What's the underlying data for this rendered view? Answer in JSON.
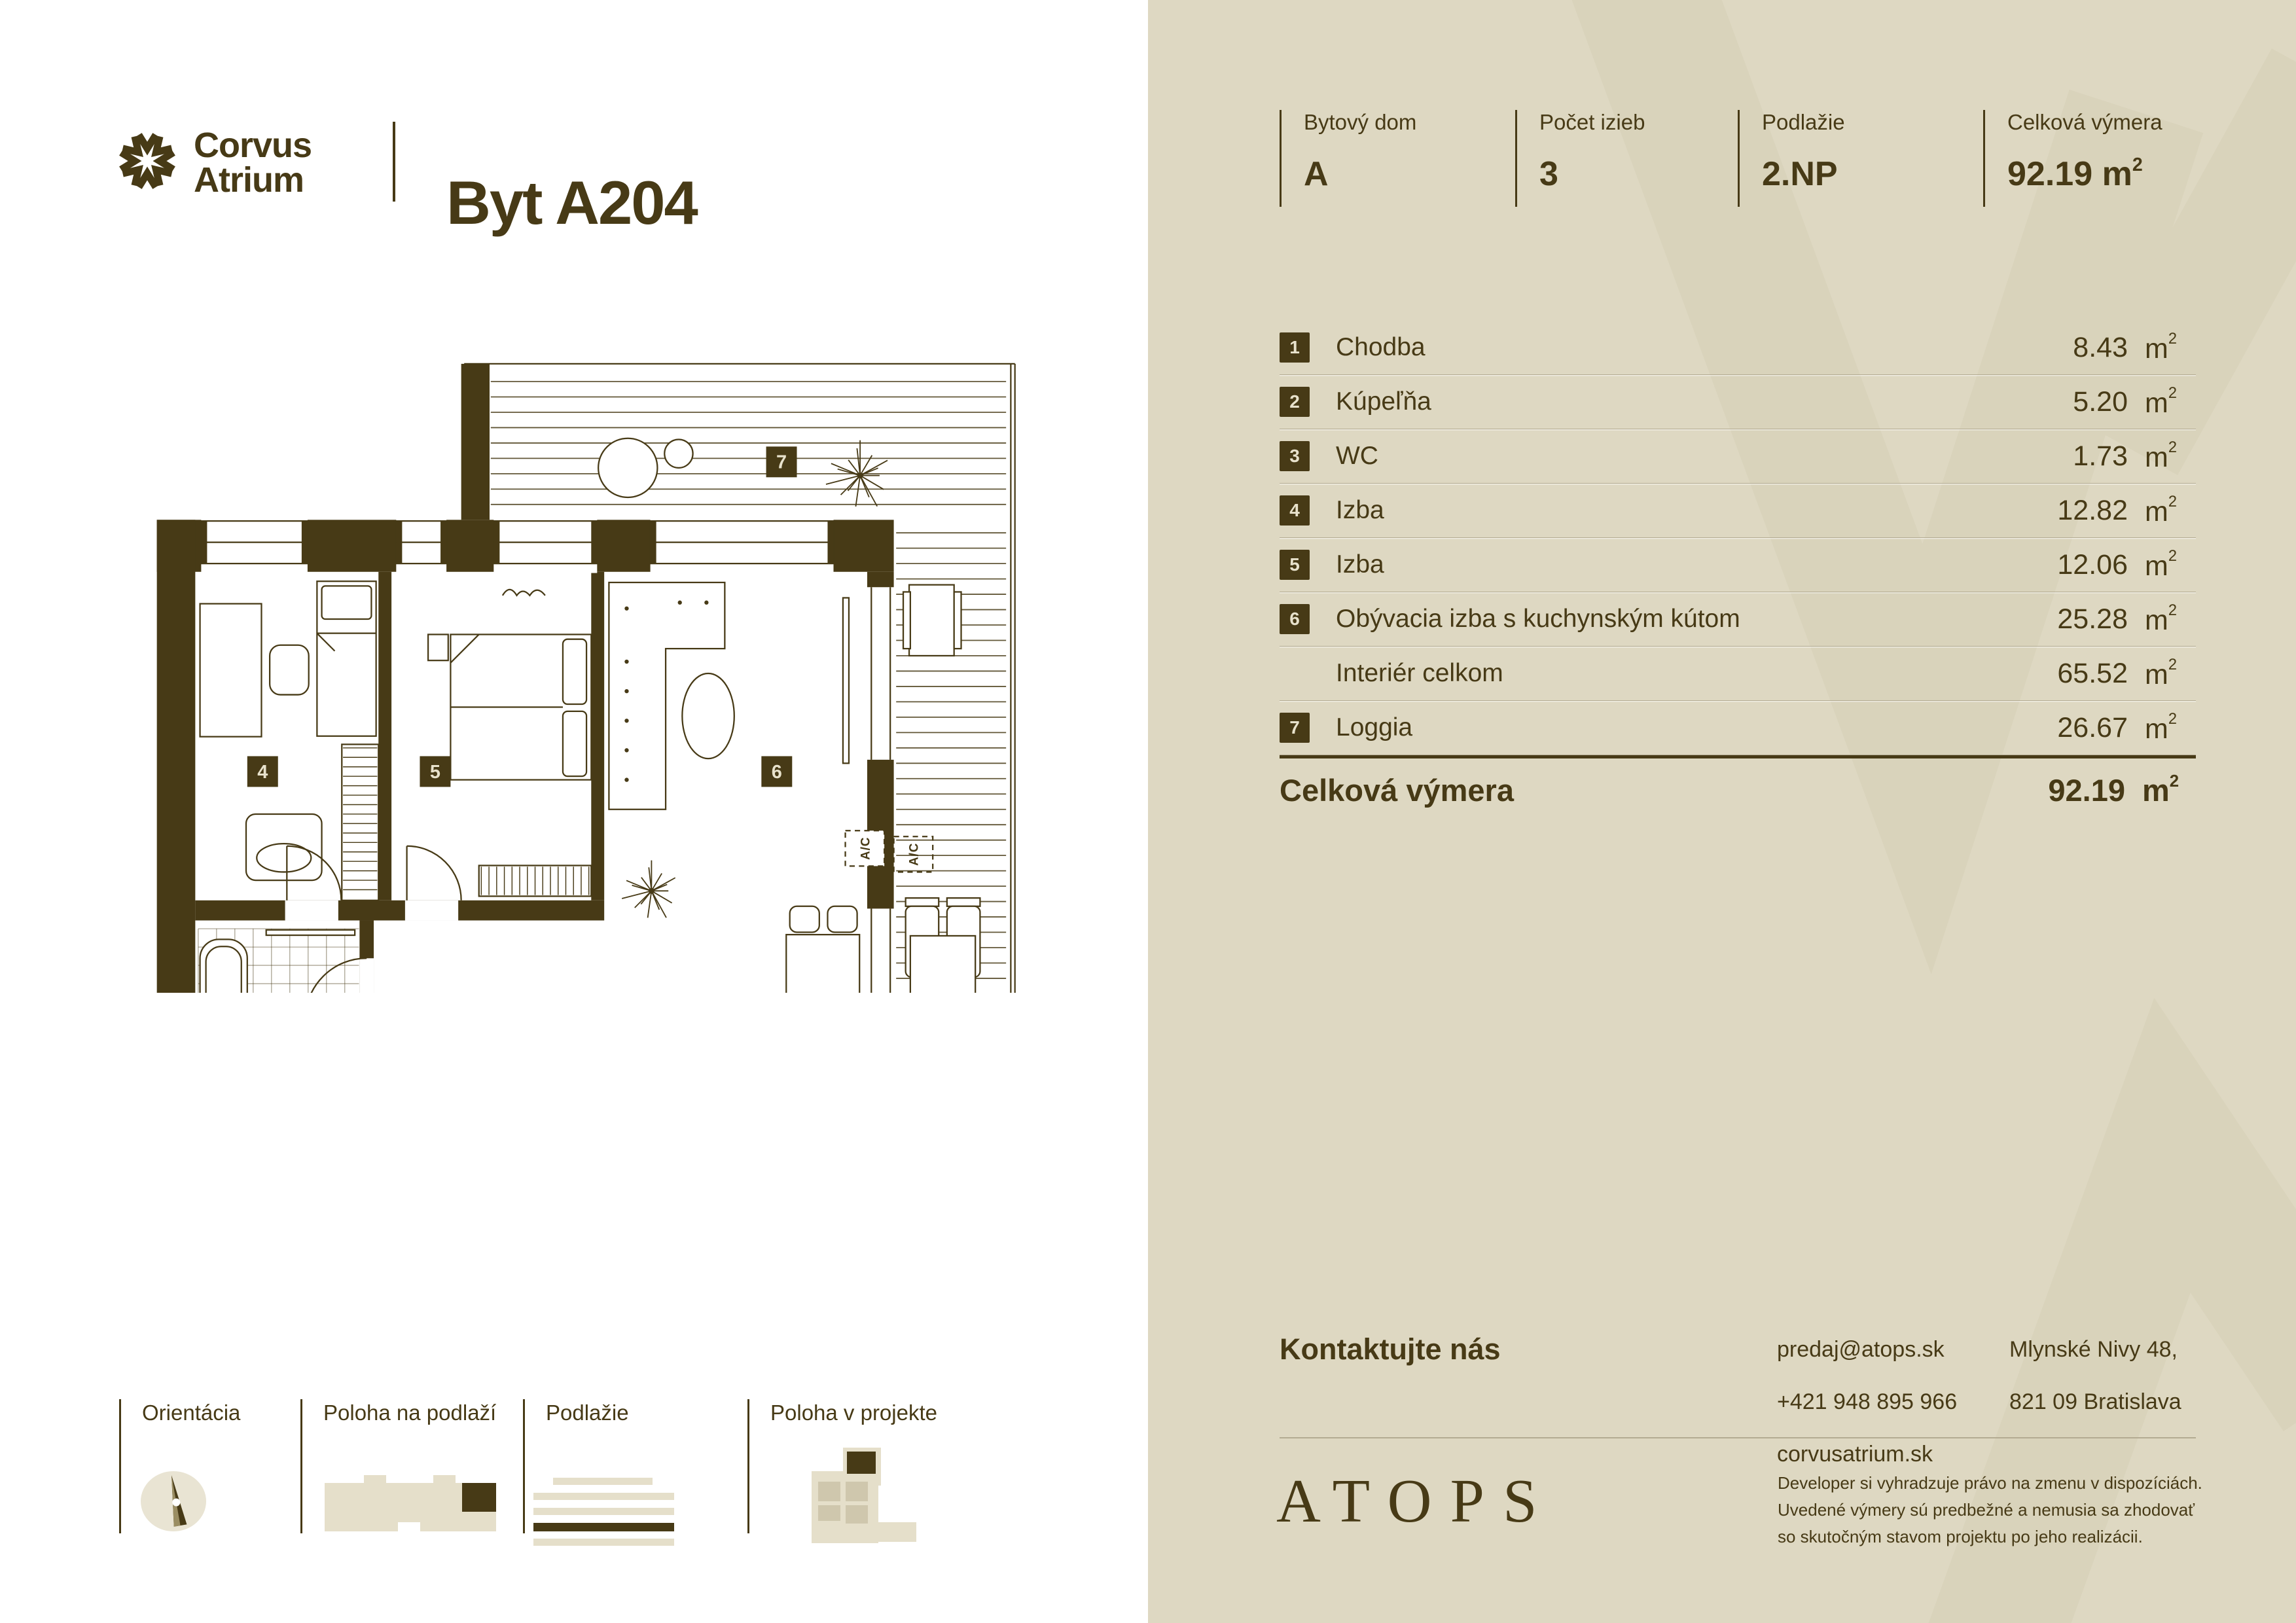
{
  "colors": {
    "accent_dark_brown": "#473a16",
    "panel_beige": "#ded8c2",
    "watermark_beige": "#d6cfb6",
    "badge_number": "#e8e2cc",
    "rule": "#b3ab92"
  },
  "brand": {
    "logo_line1": "Corvus",
    "logo_line2": "Atrium",
    "apartment": "Byt A204",
    "developer": "ATOPS"
  },
  "specs": {
    "cols": [
      {
        "label": "Bytový dom",
        "value": "A"
      },
      {
        "label": "Počet izieb",
        "value": "3"
      },
      {
        "label": "Podlažie",
        "value": "2.NP"
      },
      {
        "label": "Celková výmera",
        "value": "92.19",
        "unit_base": "m",
        "unit_sup": "2"
      }
    ]
  },
  "table": {
    "unit_base": "m",
    "unit_sup": "2",
    "rows": [
      {
        "num": "1",
        "name": "Chodba",
        "area": "8.43"
      },
      {
        "num": "2",
        "name": "Kúpeľňa",
        "area": "5.20"
      },
      {
        "num": "3",
        "name": "WC",
        "area": "1.73"
      },
      {
        "num": "4",
        "name": "Izba",
        "area": "12.82"
      },
      {
        "num": "5",
        "name": "Izba",
        "area": "12.06"
      },
      {
        "num": "6",
        "name": "Obývacia izba s kuchynským kútom",
        "area": "25.28"
      },
      {
        "num": "",
        "name": "Interiér celkom",
        "area": "65.52"
      },
      {
        "num": "7",
        "name": "Loggia",
        "area": "26.67"
      }
    ],
    "total_label": "Celková výmera",
    "total_area": "92.19"
  },
  "contact": {
    "title": "Kontaktujte nás",
    "lines": [
      "predaj@atops.sk",
      "+421 948 895 966",
      "corvusatrium.sk"
    ],
    "address": [
      "Mlynské Nivy 48,",
      "821 09 Bratislava"
    ]
  },
  "disclaimer": [
    "Developer si vyhradzuje právo na zmenu v dispozíciách.",
    "Uvedené výmery sú predbežné a nemusia sa zhodovať",
    "so skutočným stavom projektu po jeho realizácii."
  ],
  "legend": {
    "items": [
      {
        "label": "Orientácia"
      },
      {
        "label": "Poloha na podlaží"
      },
      {
        "label": "Podlažie"
      },
      {
        "label": "Poloha v projekte"
      }
    ]
  },
  "plan": {
    "ac": "A/C",
    "badges": [
      {
        "n": "1"
      },
      {
        "n": "2"
      },
      {
        "n": "3"
      },
      {
        "n": "4"
      },
      {
        "n": "5"
      },
      {
        "n": "6"
      },
      {
        "n": "7"
      }
    ]
  }
}
